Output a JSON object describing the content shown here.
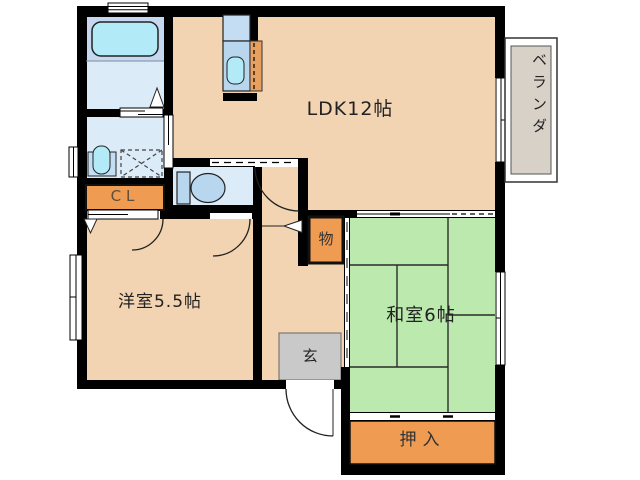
{
  "floorplan": {
    "type": "japanese-apartment-floor-plan",
    "rooms": {
      "ldk": "LDK12帖",
      "western_room": "洋室5.5帖",
      "japanese_room": "和室6帖",
      "closet": "CL",
      "storage": "物",
      "entrance": "玄",
      "futon_closet": "押入",
      "veranda": "ベランダ"
    },
    "colors": {
      "room_floor": "#f2d3b2",
      "tatami": "#bce9ad",
      "closet_accent": "#ef9b51",
      "wet_area": "#dcebf8",
      "bath_area": "#c5d8ef",
      "fixture_blue": "#b9d6ef",
      "counter_blue": "#c5ddf2",
      "tub_cyan": "#b2ebf7",
      "counter_orange": "#e8a060",
      "entrance_gray": "#c9c9c9",
      "veranda_gray": "#d8d1c7",
      "wall": "#000000"
    }
  }
}
